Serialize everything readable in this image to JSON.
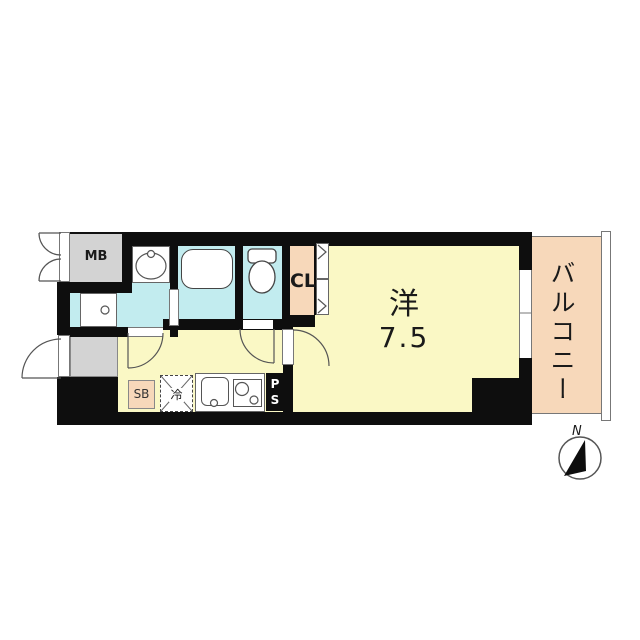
{
  "plan": {
    "type": "apartment-floor-plan",
    "colors": {
      "wall": "#0e0e0e",
      "floor_yellow": "#FAF8C5",
      "wet_area_cyan": "#C2ECEF",
      "peach": "#F7D8BA",
      "service_gray": "#D3D3D3",
      "line": "#666666",
      "background": "#ffffff"
    },
    "labels": {
      "meter_box": "MB",
      "closet": "CL",
      "room_type": "洋",
      "room_size": "7.5",
      "balcony": "バルコニー",
      "shoe_box": "SB",
      "refrigerator": "冷",
      "pipe_space_p": "P",
      "pipe_space_s": "S",
      "north": "N"
    }
  }
}
